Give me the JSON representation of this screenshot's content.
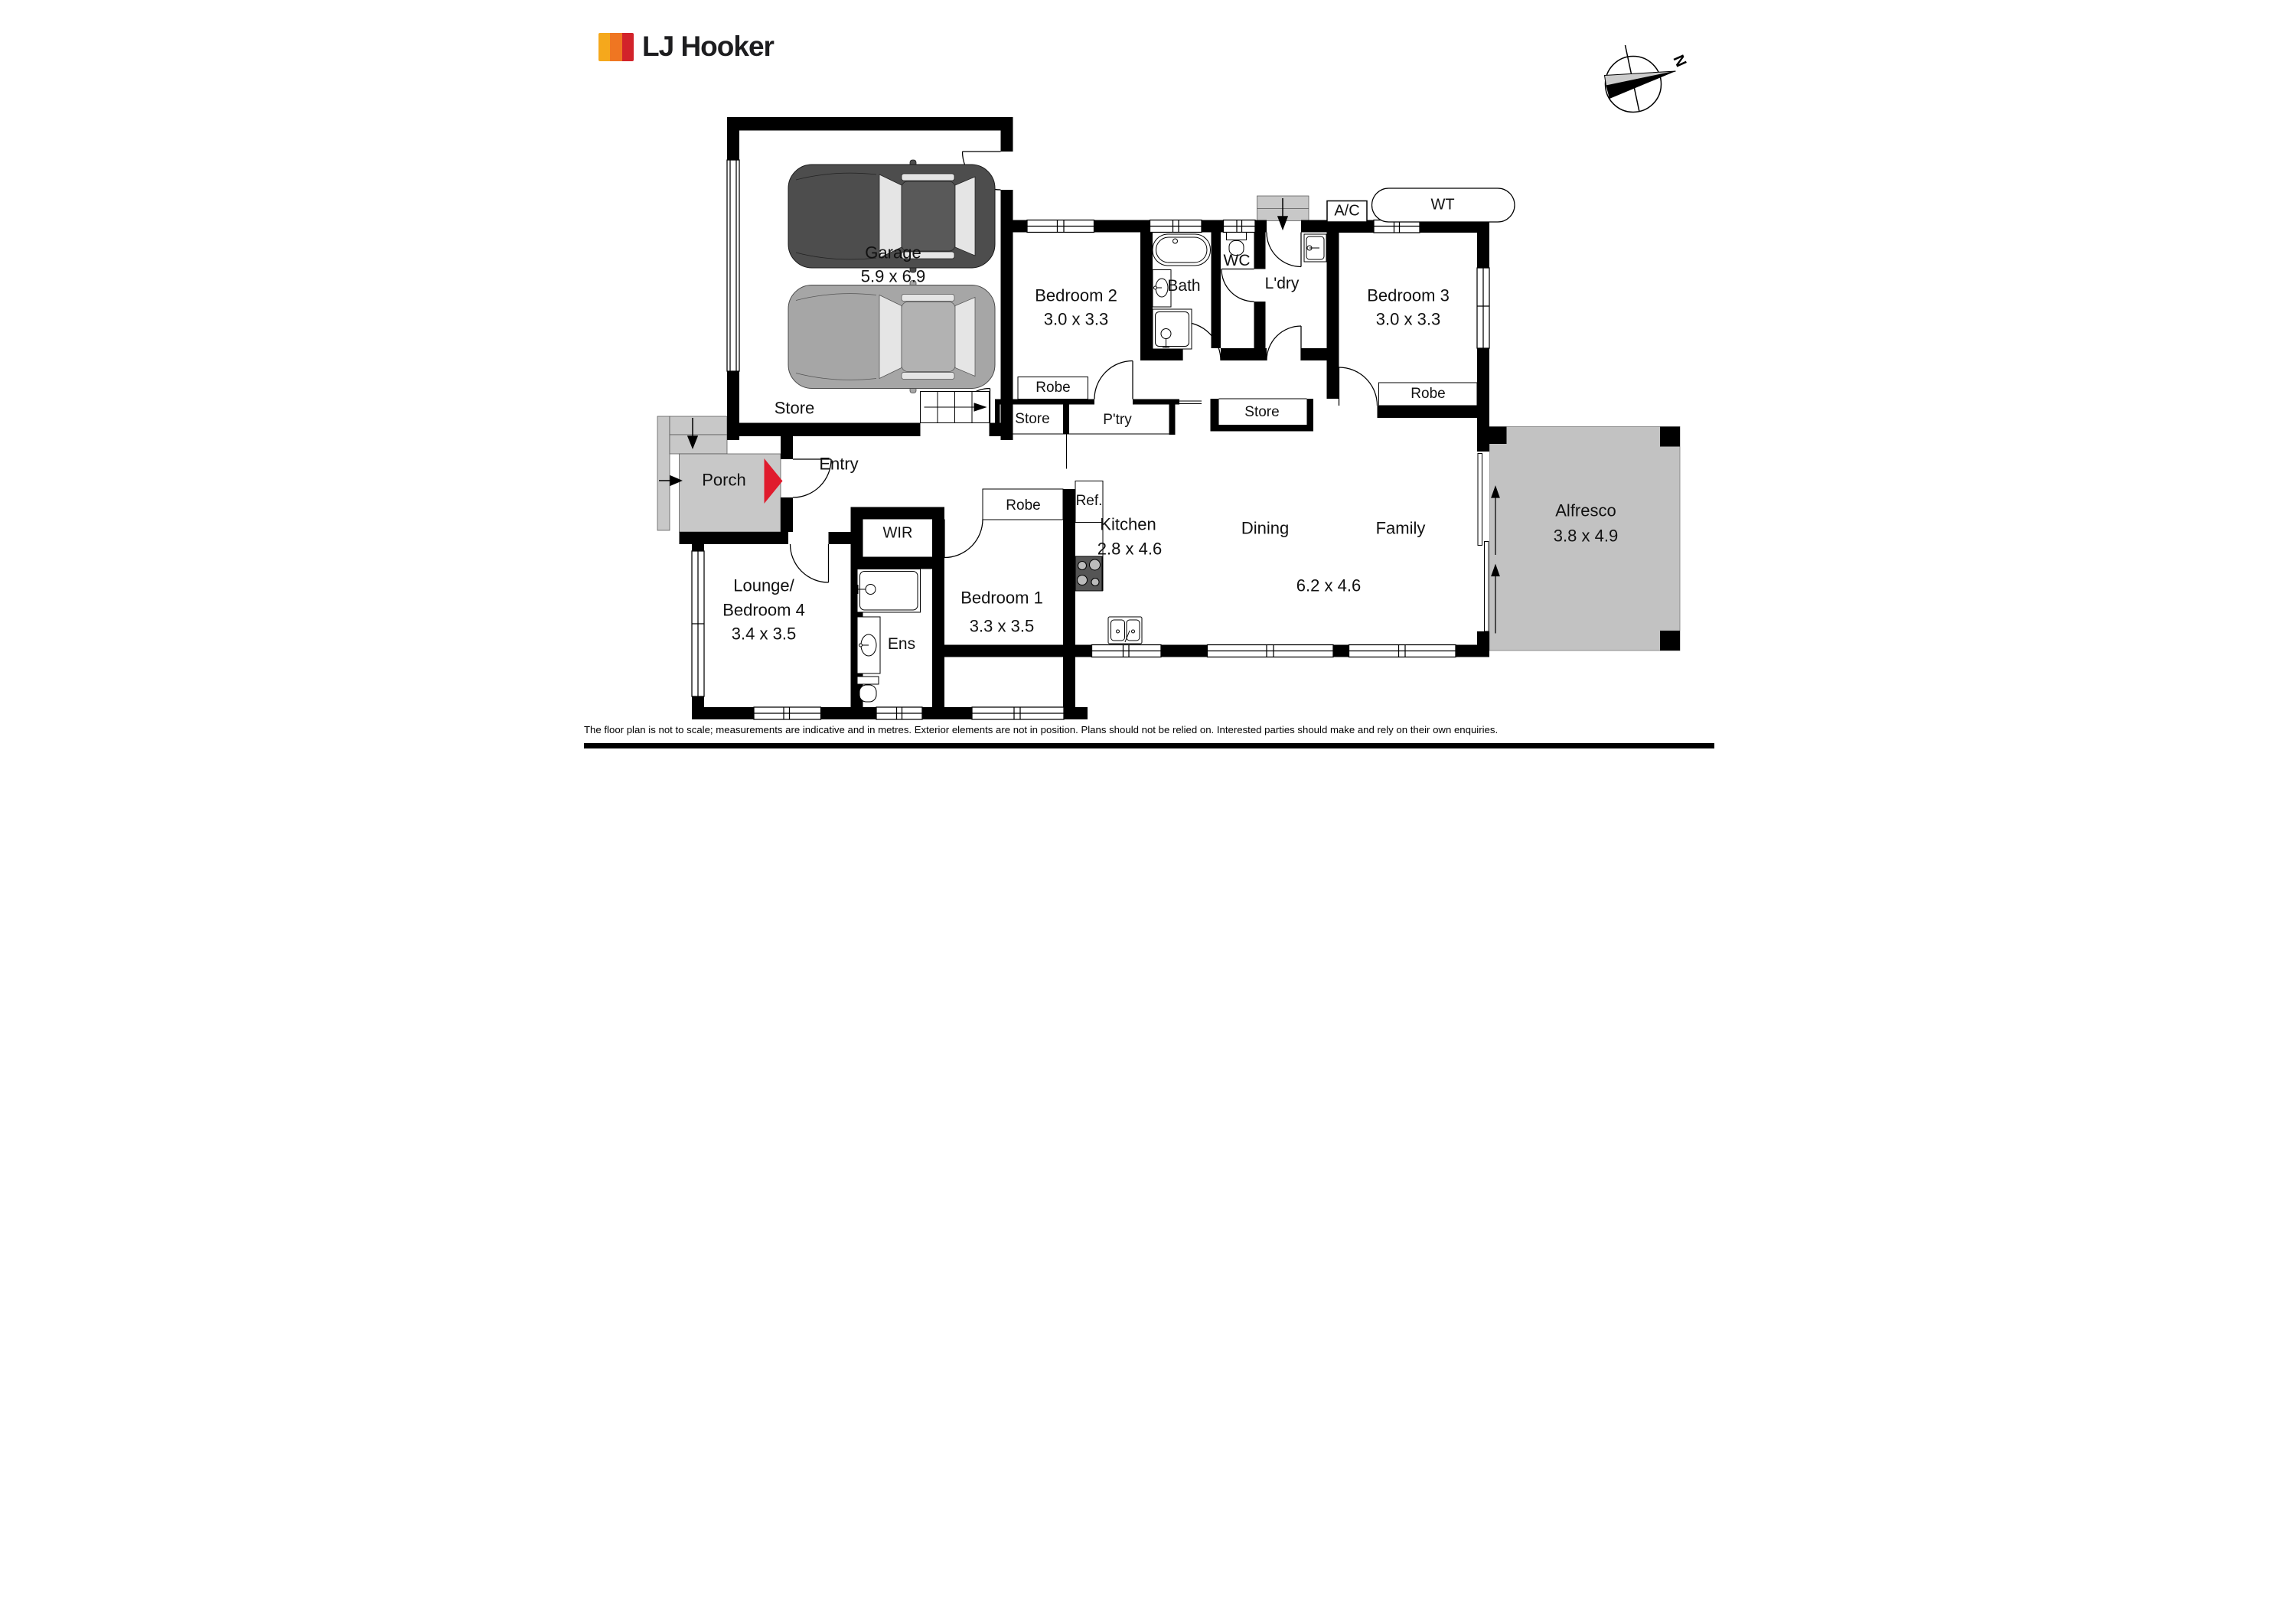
{
  "header": {
    "brand": "LJ Hooker",
    "compass_n": "N"
  },
  "labels": {
    "garage": "Garage",
    "garage_dims": "5.9 x 6.9",
    "garage_store": "Store",
    "bedroom2": "Bedroom 2",
    "bedroom2_dims": "3.0 x 3.3",
    "bedroom2_robe": "Robe",
    "hall_store": "Store",
    "pantry": "P'try",
    "bath": "Bath",
    "wc": "WC",
    "laundry": "L'dry",
    "mid_store": "Store",
    "bedroom3": "Bedroom 3",
    "bedroom3_dims": "3.0 x 3.3",
    "bedroom3_robe": "Robe",
    "ac": "A/C",
    "wt": "WT",
    "porch": "Porch",
    "entry": "Entry",
    "wir": "WIR",
    "lounge_line1": "Lounge/",
    "lounge_line2": "Bedroom 4",
    "lounge_dims": "3.4 x 3.5",
    "ens": "Ens",
    "bedroom1": "Bedroom 1",
    "bedroom1_dims": "3.3 x 3.5",
    "bedroom1_robe": "Robe",
    "fridge": "Ref.",
    "kitchen": "Kitchen",
    "kitchen_dims": "2.8 x 4.6",
    "dining": "Dining",
    "family": "Family",
    "living_dims": "6.2 x 4.6",
    "alfresco": "Alfresco",
    "alfresco_dims": "3.8 x 4.9"
  },
  "footer": {
    "disclaimer": "The floor plan is not to scale; measurements are indicative and in metres. Exterior elements are not in position. Plans should not be relied on. Interested parties should make and rely on their own enquiries."
  },
  "colors": {
    "brand_gold": "#F5A81C",
    "brand_orange": "#EF7622",
    "brand_red": "#D2232A",
    "entry_marker_red": "#E01B2D",
    "outdoor_gray": "#C8C8C8",
    "alfresco_gray": "#C2C2C2",
    "wall_black": "#000000"
  },
  "icons": [
    "north-compass-icon",
    "car-top-view-icon",
    "bathtub-icon",
    "shower-icon",
    "toilet-icon",
    "vanity-sink-icon",
    "laundry-sink-icon",
    "kitchen-sink-icon",
    "cooktop-icon",
    "stairs-icon",
    "door-swing-icon",
    "sliding-door-icon",
    "entry-arrow-icon",
    "path-arrow-icon"
  ]
}
